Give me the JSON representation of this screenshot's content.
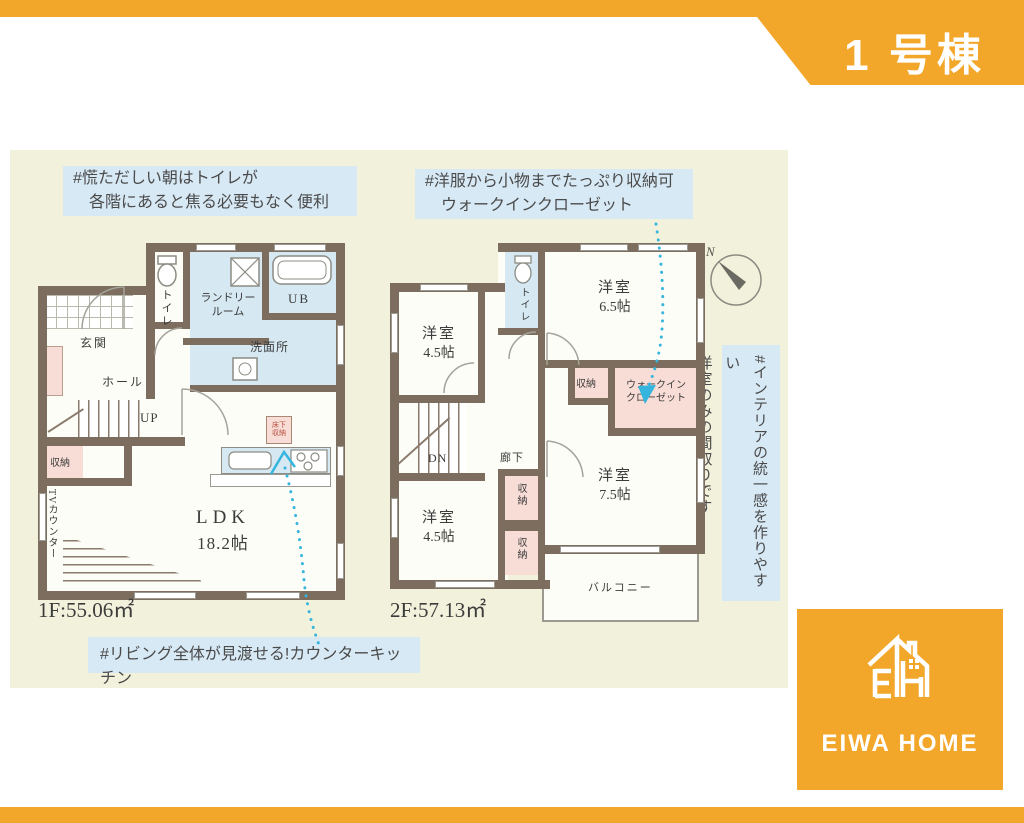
{
  "banner": {
    "title": "1 号棟"
  },
  "annotations": {
    "toilet": {
      "line1": "#慌ただしい朝はトイレが",
      "line2": "各階にあると焦る必要もなく便利"
    },
    "closet": {
      "line1": "#洋服から小物までたっぷり収納可",
      "line2": "ウォークインクローゼット"
    },
    "interior": {
      "line1": "#インテリアの統一感を作りやすい",
      "line2": "洋室のみの間取りです"
    },
    "kitchen": {
      "line1": "#リビング全体が見渡せる!カウンターキッチン"
    }
  },
  "compass": {
    "label": "N"
  },
  "floor1": {
    "area": "1F:55.06㎡",
    "rooms": {
      "toilet": "トイレ",
      "laundry1": "ランドリー",
      "laundry2": "ルーム",
      "ub": "UB",
      "washroom": "洗面所",
      "entrance": "玄関",
      "hall": "ホール",
      "stairs": "UP",
      "storage": "収納",
      "tv_counter": "TVカウンター",
      "ldk_name": "LDK",
      "ldk_size": "18.2帖",
      "underfloor1": "床下",
      "underfloor2": "収納"
    }
  },
  "floor2": {
    "area": "2F:57.13㎡",
    "rooms": {
      "toilet": "トイレ",
      "room_name": "洋室",
      "size65": "6.5帖",
      "size45": "4.5帖",
      "size75": "7.5帖",
      "storage": "収納",
      "wic1": "ウォークイン",
      "wic2": "クローゼット",
      "stairs": "DN",
      "corridor": "廊下",
      "balcony": "バルコニー"
    }
  },
  "logo": {
    "text": "EIWA HOME"
  },
  "colors": {
    "accent_orange": "#F3A72A",
    "annotation_blue": "#D7E9F5",
    "wall_brown": "#7D6D5F",
    "wet_area_blue": "#D6E9F3",
    "storage_pink": "#F8DCD6",
    "background_cream": "#F1F1DC",
    "dotted_line_cyan": "#35B5DE"
  }
}
